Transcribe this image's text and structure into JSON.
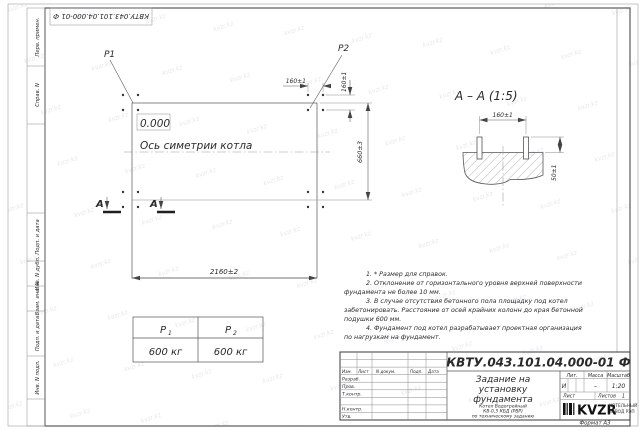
{
  "drawing": {
    "number": "КВТУ.043.101.04.000-01  Ф"
  },
  "watermark": {
    "text": "kvzr.kz"
  },
  "frame_left": {
    "labels": [
      "Перв. примен.",
      "Справ. N",
      "Подп. и дата",
      "Инв. N дубл.",
      "Взам. инв. N",
      "Подп. и дата",
      "Инв. N подл."
    ]
  },
  "plan": {
    "p1_label": "P1",
    "p2_label": "P2",
    "elevation": "0.000",
    "axis_label": "Ось симетрии котла",
    "dim_width": "2160±2",
    "dim_height": "660±3",
    "dim_bolt_x": "160±1",
    "dim_bolt_y": "160±1",
    "section_letter": "А"
  },
  "section": {
    "title": "А – А (1:5)",
    "dim_spacing": "160±1",
    "dim_height": "50±1"
  },
  "load_table": {
    "col1": {
      "label": "P",
      "sub": "1",
      "value": "600 кг"
    },
    "col2": {
      "label": "P",
      "sub": "2",
      "value": "600 кг"
    }
  },
  "notes": {
    "lines": [
      "1. * Размер для справок.",
      "2. Отклонение от горизонтального уровня верхней поверхности",
      "фундамента не более 10 мм.",
      "3. В случае отсутствия бетонного пола площадку под котел",
      "забетонировать. Расстояние от осей крайних колонн до края бетонной",
      "подушки 600 мм.",
      "4. Фундамент под котел разрабатывает проектная организация",
      "по нагрузкам на фундамент."
    ]
  },
  "title_block": {
    "title_line1": "Задание на",
    "title_line2": "установку",
    "title_line3": "фундамента",
    "subtitle_line1": "Котел Водогрейный",
    "subtitle_line2": "КВ-0,5 КБД (РВР)",
    "subtitle_line3": "по техническому заданию",
    "col_izm": "Изм.",
    "col_list": "Лист",
    "col_doc": "N докум.",
    "col_podp": "Подп.",
    "col_data": "Дата",
    "row_razrab": "Разраб.",
    "row_prov": "Пров.",
    "row_tkontr": "Т.контр.",
    "row_nkontr": "Н.контр.",
    "row_utv": "Утв.",
    "lit_header": "Лит.",
    "mass_header": "Масса",
    "scale_header": "Масштаб",
    "lit_value": "И",
    "mass_value": "–",
    "scale_value": "1:20",
    "sheet_label": "Лист",
    "sheets_label": "Листов",
    "sheets_value": "1",
    "logo_text": "KVZR",
    "logo_sub1": "КОТЕЛЬНЫЙ",
    "logo_sub2": "ЗАВОД РЭП",
    "format_label": "Формат А3"
  }
}
